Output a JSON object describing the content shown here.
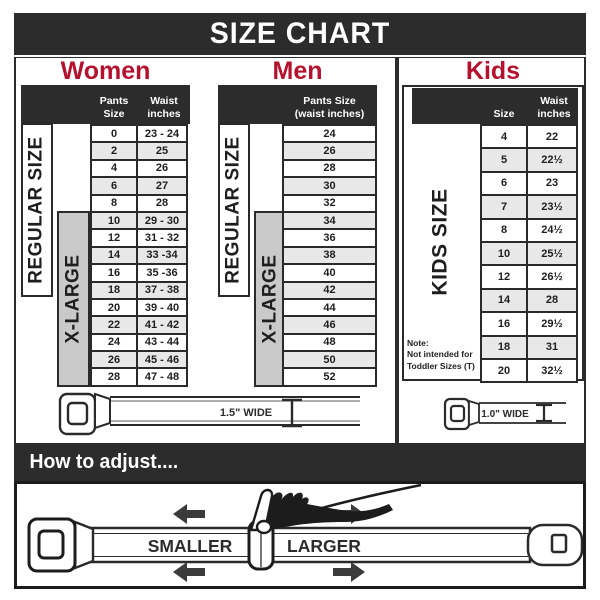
{
  "title": "SIZE CHART",
  "colors": {
    "dark": "#2c2c2c",
    "accent_red": "#b4112e",
    "xlarge_gray": "#c9c9c9",
    "row_shade": "#e8e8e8"
  },
  "women": {
    "heading": "Women",
    "col1_header": "Pants Size",
    "col2_header_line1": "Waist",
    "col2_header_line2": "inches",
    "regular_label": "REGULAR SIZE",
    "xlarge_label": "X-LARGE",
    "rows": [
      [
        "0",
        "23 - 24"
      ],
      [
        "2",
        "25"
      ],
      [
        "4",
        "26"
      ],
      [
        "6",
        "27"
      ],
      [
        "8",
        "28"
      ],
      [
        "10",
        "29 - 30"
      ],
      [
        "12",
        "31 - 32"
      ],
      [
        "14",
        "33 -34"
      ],
      [
        "16",
        "35 -36"
      ],
      [
        "18",
        "37 - 38"
      ],
      [
        "20",
        "39 - 40"
      ],
      [
        "22",
        "41 - 42"
      ],
      [
        "24",
        "43 - 44"
      ],
      [
        "26",
        "45 - 46"
      ],
      [
        "28",
        "47 - 48"
      ]
    ]
  },
  "men": {
    "heading": "Men",
    "header_line1": "Pants Size",
    "header_line2": "(waist inches)",
    "regular_label": "REGULAR SIZE",
    "xlarge_label": "X-LARGE",
    "rows": [
      "24",
      "26",
      "28",
      "30",
      "32",
      "34",
      "36",
      "38",
      "40",
      "42",
      "44",
      "46",
      "48",
      "50",
      "52"
    ]
  },
  "kids": {
    "heading": "Kids",
    "col1_header": "Size",
    "col2_header_line1": "Waist",
    "col2_header_line2": "inches",
    "side_label": "KIDS SIZE",
    "note_line1": "Note:",
    "note_line2": "Not intended for",
    "note_line3": "Toddler Sizes (T)",
    "rows": [
      [
        "4",
        "22"
      ],
      [
        "5",
        "22½"
      ],
      [
        "6",
        "23"
      ],
      [
        "7",
        "23½"
      ],
      [
        "8",
        "24½"
      ],
      [
        "10",
        "25½"
      ],
      [
        "12",
        "26½"
      ],
      [
        "14",
        "28"
      ],
      [
        "16",
        "29½"
      ],
      [
        "18",
        "31"
      ],
      [
        "20",
        "32½"
      ]
    ]
  },
  "belts": {
    "adult_width_label": "1.5\" WIDE",
    "kids_width_label": "1.0\" WIDE"
  },
  "adjust": {
    "heading": "How to adjust....",
    "smaller_label": "SMALLER",
    "larger_label": "LARGER"
  }
}
